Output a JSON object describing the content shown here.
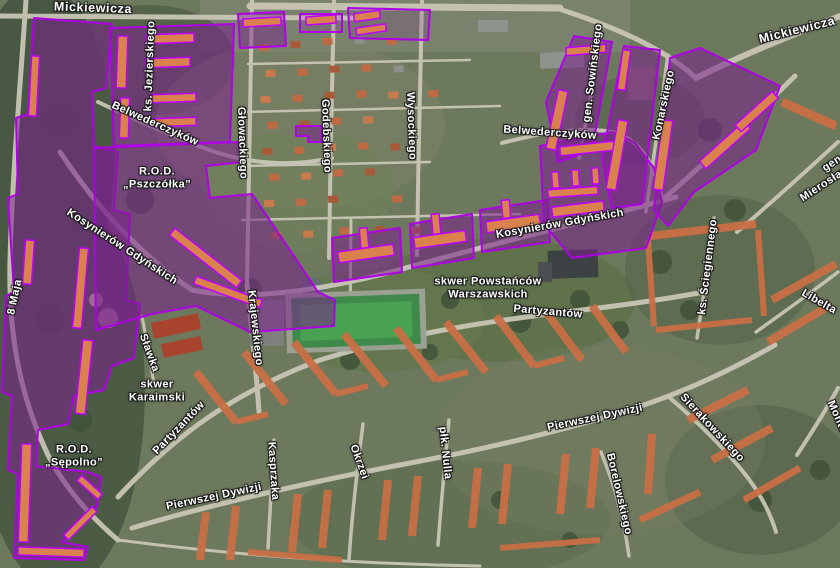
{
  "map": {
    "view": "aerial-imagery-with-highlight-overlay",
    "colors": {
      "highlight_fill": "#7a208d",
      "highlight_stroke": "#b000e6",
      "roof_orange": "#c96f45",
      "road": "#ccc8b8",
      "label_text": "#ffffff",
      "label_halo": "#1a1a1a"
    },
    "labels": [
      {
        "id": "mickiewicza-west",
        "text": "Mickiewicza"
      },
      {
        "id": "mickiewicza-east",
        "text": "Mickiewicza"
      },
      {
        "id": "ks-jezierskiego",
        "text": "ks. Jezierskiego"
      },
      {
        "id": "belwederczykow-west",
        "text": "Belwederczyków"
      },
      {
        "id": "belwederczykow-east",
        "text": "Belwederczyków"
      },
      {
        "id": "glowackiego",
        "text": "Głowackiego"
      },
      {
        "id": "godebskiego",
        "text": "Godebskiego"
      },
      {
        "id": "wysockiego",
        "text": "Wysockiego"
      },
      {
        "id": "gen-sowinskiego",
        "text": "gen. Sowińskiego"
      },
      {
        "id": "konarskiego",
        "text": "Konarskiego"
      },
      {
        "id": "rod-pszczolka",
        "text": "R.O.D.\n„Pszczółka”"
      },
      {
        "id": "kosynierow-gdynskich-west",
        "text": "Kosynierów Gdyńskich"
      },
      {
        "id": "kosynierow-gdynskich-east",
        "text": "Kosynierów Gdyńskich"
      },
      {
        "id": "krajewskiego",
        "text": "Krajewskiego"
      },
      {
        "id": "skwer-powstancow-warszawskich",
        "text": "skwer Powstańców\nWarszawskich"
      },
      {
        "id": "partyzantow-west",
        "text": "Partyzantów"
      },
      {
        "id": "partyzantow-east",
        "text": "Partyzantów"
      },
      {
        "id": "slawka",
        "text": "Sławka"
      },
      {
        "id": "skwer-karaimski",
        "text": "skwer\nKaraimski"
      },
      {
        "id": "rod-sepolno",
        "text": "R.O.D.\n„Sępolno”"
      },
      {
        "id": "pierwszej-dywizji-west",
        "text": "Pierwszej Dywizji"
      },
      {
        "id": "pierwszej-dywizji-east",
        "text": "Pierwszej Dywizji"
      },
      {
        "id": "kasprzaka",
        "text": "Kasprzaka"
      },
      {
        "id": "okrzei",
        "text": "Okrzei"
      },
      {
        "id": "plk-nulla",
        "text": "płk. Nulla"
      },
      {
        "id": "borelowskiego",
        "text": "Borelowskiego"
      },
      {
        "id": "sierakowskiego",
        "text": "Sierakowskiego"
      },
      {
        "id": "ks-sciegiennego",
        "text": "ks. Ściegiennego"
      },
      {
        "id": "gen-mieroslawskiego",
        "text": "gen. Mierosławskiego"
      },
      {
        "id": "libelta",
        "text": "Libelta"
      },
      {
        "id": "osma-maja",
        "text": "8 Maja"
      },
      {
        "id": "monte",
        "text": "Monte"
      }
    ]
  }
}
